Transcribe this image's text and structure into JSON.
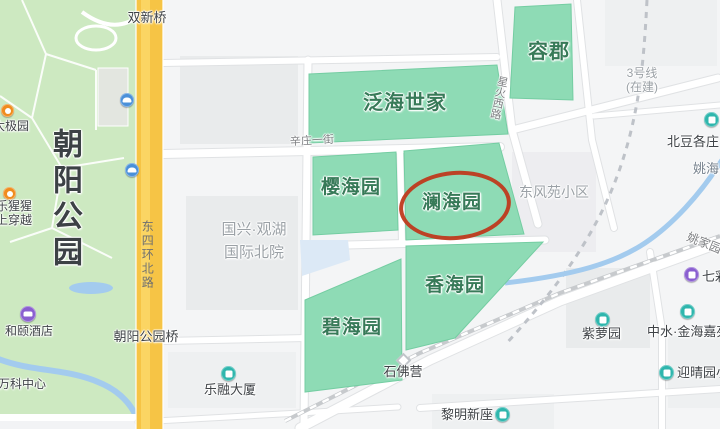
{
  "map_type": "city-map",
  "highlight": {
    "circled_compound": "澜海园",
    "annotation_color": "#bf3a1e"
  },
  "park": {
    "name": "朝阳公园",
    "taiji": "太极园",
    "canopy_line1": "乐猩猩",
    "canopy_line2": "上穿越",
    "hotel": "和颐酒店",
    "vanke_center": "万科中心"
  },
  "roads": {
    "dongsihuan_north": "东四环北路",
    "xinzhuang_first": "辛庄一街",
    "xinghuo_west": "星火西路",
    "yaojiayuan": "姚家园"
  },
  "bridges": {
    "shuangxin": "双新桥",
    "chaoyang_park": "朝阳公园桥"
  },
  "metro": {
    "line": "3号线",
    "status": "(在建)"
  },
  "compounds": {
    "fanhai": "泛海世家",
    "rongjun": "容郡",
    "yinghai": "樱海园",
    "lanhai": "澜海园",
    "xianghai": "香海园",
    "bihai": "碧海园"
  },
  "places": {
    "guoxing_line1": "国兴·观湖",
    "guoxing_line2": "国际北院",
    "dongfengyuan": "东风苑小区",
    "beidougezhuang": "北豆各庄",
    "yaohai": "姚海",
    "qicai": "七彩",
    "zhongshui": "中水·金海嘉苑",
    "ziluoyuan": "紫萝园",
    "yingqingyuan": "迎晴园小",
    "shifoying": "石佛营",
    "liming_xinzuo": "黎明新座",
    "lerong_tower": "乐融大厦"
  },
  "colors": {
    "park_green": "#cde9c1",
    "compound_green": "#8edbb5",
    "road_yellow": "#f6c445",
    "water_blue": "#a3cbee",
    "poi_teal": "#2fb6ad",
    "poi_purple": "#8a5fd0",
    "poi_orange": "#f08c1e",
    "poi_blue": "#4a90d9",
    "highlight_red": "#bf3a1e"
  }
}
